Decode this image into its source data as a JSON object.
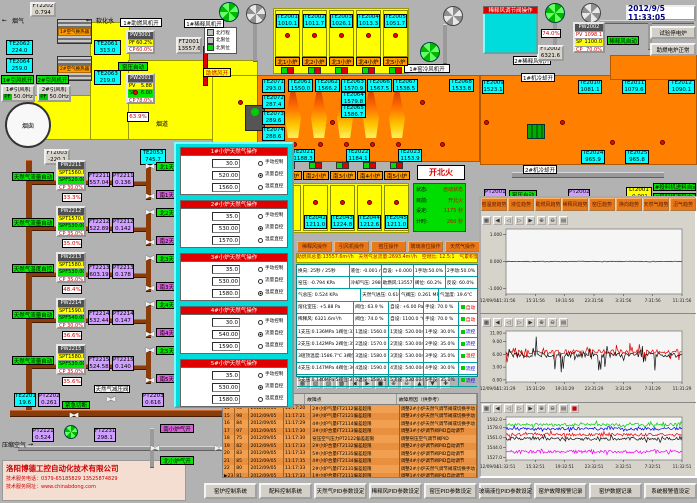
{
  "window": {
    "datetime": "2012/9/5 11:33:05"
  },
  "company": {
    "name": "洛阳博德工控自动化技术有限公司",
    "phone": "技术服务电话：0379-65185829  13525874829",
    "web": "技术服务网址：www.chinabdong.com"
  },
  "icons": {
    "valve": "▶◀",
    "left_arrow": "←",
    "right_arrow": "→",
    "row_pointer": "▶"
  },
  "labels": {
    "smoke": "烟气",
    "soft_water": "软化水",
    "hx1": "1#空气换热器",
    "hx2": "2#空气换热器",
    "fan1_on": "1#引风机开",
    "fan2_on": "2#引风机开",
    "fan1": "1#引风机",
    "fan2": "2#引风机",
    "pf": "PF",
    "fan1_hz": "50.0Hz",
    "fan2_hz": "50.0Hz",
    "chimney": "烟囱",
    "flue": "烟道",
    "damper_pct": "63.9%",
    "kiln_auto": "窑压自动",
    "kiln_auto2": "窑压自动",
    "blower1_on": "1#助燃风机开",
    "dilution1_on": "1#稀释风机开",
    "dilution2_on": "2#稀释风机开",
    "comb_air_on": "助燃风开",
    "mix_auto": "稀释风自动",
    "cool1": "1#机冷却开",
    "cool2": "2#机冷却开",
    "kiln_cool_fan": "1#窑冷风机开",
    "feed1": "1#投料机进料自动",
    "feed2": "2#投料机进料自动",
    "fire_mode": "开北火",
    "emergency": "紧急切断",
    "reducer_valve": "天然气减压阀",
    "comp_air": "压缩空气",
    "south_air_on": "南小炉气开",
    "north_air_on": "北小炉气开",
    "test_btn": "试验停电炉",
    "aux_btn": "助燃电炉正常",
    "limit_legend": [
      "北行程",
      "北限位",
      "北到位"
    ]
  },
  "inst": {
    "ft2202": [
      "FT2202",
      "0.794"
    ],
    "te2062": [
      "TE2062",
      "224.0"
    ],
    "te2061": [
      "TE2061",
      "313.0"
    ],
    "te2064": [
      "TE2064",
      "259.0"
    ],
    "te2063": [
      "TE2063",
      "219.0"
    ],
    "ft2001": [
      "FT2001",
      "13557.6"
    ],
    "ft2003": [
      "FT2003",
      "-220.1"
    ],
    "te2053": [
      "TE2053",
      "745.7"
    ],
    "ft2002": [
      "FT2002",
      "6321.6"
    ],
    "te2201": [
      "TE2201",
      "19.6"
    ],
    "pt2202": [
      "PT2202",
      "0.261"
    ],
    "pt2203": [
      "PT2203",
      "0.616"
    ],
    "pt2121": [
      "PT2121",
      "0.524"
    ],
    "ft2231": [
      "FT2231",
      "298.1"
    ],
    "pt2001": [
      "PT2001",
      "5.88"
    ],
    "pt2002": [
      "PT2002",
      "6.96"
    ],
    "lt2001": [
      "LT2001",
      "-0.001"
    ],
    "te2009": [
      "TE2009",
      "1523.1"
    ],
    "te2010": [
      "TE2010",
      "1081.1"
    ],
    "te2011": [
      "TE2011",
      "1079.6"
    ],
    "te2012": [
      "TE2012",
      "1090.1"
    ],
    "te2024": [
      "TE2024",
      "965.9"
    ],
    "te2025": [
      "TE2025",
      "965.8"
    ],
    "te2021": [
      "TE2021",
      "1188.3"
    ],
    "te2022": [
      "TE2022",
      "1184.1"
    ],
    "te2023": [
      "TE2023",
      "1153.9"
    ]
  },
  "north_block": {
    "title": "蓄热室",
    "te": [
      [
        "TE2001",
        "1010.1"
      ],
      [
        "TE2002",
        "1011.7"
      ],
      [
        "TE2003",
        "1026.1"
      ],
      [
        "TE2004",
        "1013.3"
      ],
      [
        "TE2005",
        "1051.7"
      ]
    ],
    "ports": [
      "北1小炉",
      "北2小炉",
      "北3小炉",
      "北4小炉",
      "北5小炉"
    ]
  },
  "south_block": {
    "title": "蓄热室",
    "te": [
      [
        "TE2042",
        "1211.0"
      ],
      [
        "TE2043",
        "1224.8"
      ],
      [
        "TE2044",
        "1212.6"
      ],
      [
        "TE2045",
        "1211.0"
      ]
    ],
    "ports": [
      "南1小炉",
      "南2小炉",
      "南3小炉",
      "南4小炉",
      "南5小炉"
    ]
  },
  "furnace": {
    "left_te": [
      [
        "TE2071",
        "293.0"
      ],
      [
        "TE2072",
        "287.4"
      ],
      [
        "TE2073",
        "289.6"
      ],
      [
        "TE2074",
        "288.6"
      ],
      [
        "TE2075",
        "291.7"
      ]
    ],
    "flame_te": [
      [
        "TE2061",
        "1550.0"
      ],
      [
        "TE2062",
        "1566.2"
      ],
      [
        "TE2063",
        "1570.9"
      ],
      [
        "TE2064",
        "1579.8"
      ],
      [
        "TE2065",
        "1586.7"
      ],
      [
        "TE2066",
        "1567.5"
      ],
      [
        "TE2067",
        "1538.5"
      ],
      [
        "TE2068",
        "1533.8"
      ]
    ]
  },
  "controllers": {
    "pw2001": {
      "id": "PW2001",
      "rows": [
        [
          "PV",
          "5.88"
        ],
        [
          "SP",
          "6.00"
        ],
        [
          "CP",
          "78.0%"
        ]
      ]
    },
    "pw3001": {
      "id": "PW3001",
      "rows": [
        [
          "PF",
          "60.2%"
        ],
        [
          "CP",
          "60.0%"
        ]
      ]
    },
    "pw2002": {
      "id": "PW2002",
      "rows": [
        [
          "PV",
          "1098.1"
        ],
        [
          "SP",
          "1100.0"
        ],
        [
          "CP",
          "70.0%"
        ]
      ]
    }
  },
  "dilution_popup": {
    "title": "稀释风调节阀操作",
    "manual_btn": "PV2002手动",
    "auto_btn": "自动",
    "rows": [
      [
        "PV2002自设:",
        "1100.0",
        "℃"
      ],
      [
        "PV2002手设:",
        "70.0",
        "%"
      ]
    ],
    "valve_pct": "74.0%"
  },
  "status_panel": {
    "rows": [
      [
        "状态:",
        "自动状态"
      ],
      [
        "目前:",
        "开北火"
      ],
      [
        "设定:",
        "1175 秒"
      ],
      [
        "计时:",
        "260 秒"
      ]
    ]
  },
  "gas_branches": {
    "row_labels": [
      "SPT",
      "SPF",
      "CP"
    ],
    "items": [
      {
        "id": "PW2211",
        "spt": "1560.0",
        "spf": "520.00",
        "cp": "30.0%",
        "pct": "33.3%",
        "ft": [
          "FT2211",
          "557.04"
        ],
        "pt": [
          "PT2211",
          "0.136"
        ],
        "mode": "天然气流量自动",
        "north": "北1天然气开",
        "south": "南1天然气开"
      },
      {
        "id": "PW2212",
        "spt": "1570.0",
        "spf": "530.00",
        "cp": "35.0%",
        "pct": "35.0%",
        "ft": [
          "FT2212",
          "522.89"
        ],
        "pt": [
          "PT2212",
          "0.142"
        ],
        "mode": "天然气流量自动",
        "north": "北2天然气开",
        "south": "南2天然气开"
      },
      {
        "id": "PW2213",
        "spt": "1580.0",
        "spf": "530.00",
        "cp": "35.0%",
        "pct": "48.4%",
        "ft": [
          "FT2213",
          "603.19"
        ],
        "pt": [
          "PT2213",
          "0.178"
        ],
        "mode": "天然气温度自控",
        "north": "北3天然气开",
        "south": "南3天然气开"
      },
      {
        "id": "PW2214",
        "spt": "1590.0",
        "spf": "540.00",
        "cp": "30.0%",
        "pct": "36.6%",
        "ft": [
          "FT2214",
          "532.44"
        ],
        "pt": [
          "PT2214",
          "0.147"
        ],
        "mode": "天然气流量自动",
        "north": "北4天然气开",
        "south": "南4天然气开"
      },
      {
        "id": "PW2215",
        "spt": "1580.0",
        "spf": "530.00",
        "cp": "35.0%",
        "pct": "35.6%",
        "ft": [
          "FT2215",
          "524.58"
        ],
        "pt": [
          "PT2215",
          "0.140"
        ],
        "mode": "天然气流量自动",
        "north": "北5天然气开",
        "south": "南5天然气开"
      }
    ]
  },
  "gas_popup": {
    "field_labels": [
      "手动设定:",
      "流量设定:",
      "温度设定:"
    ],
    "units": [
      "%",
      "m³/h",
      "℃"
    ],
    "radios": [
      "手动控制",
      "流量自控",
      "温度直控"
    ],
    "panels": [
      {
        "title": "1#小炉天然气操作",
        "manual": "30.0",
        "flow": "520.00",
        "temp": "1560.0",
        "sel": 1
      },
      {
        "title": "2#小炉天然气操作",
        "manual": "35.0",
        "flow": "530.00",
        "temp": "1570.0",
        "sel": 1
      },
      {
        "title": "3#小炉天然气操作",
        "manual": "35.0",
        "flow": "530.00",
        "temp": "1580.0",
        "sel": 2
      },
      {
        "title": "4#小炉天然气操作",
        "manual": "30.0",
        "flow": "540.00",
        "temp": "1590.0",
        "sel": 1
      },
      {
        "title": "5#小炉天然气操作",
        "manual": "35.0",
        "flow": "530.00",
        "temp": "1580.0",
        "sel": 1
      }
    ]
  },
  "op_buttons": [
    "稀释风操作",
    "引风机操作",
    "窑压操作",
    "玻璃液位操作",
    "天然气操作"
  ],
  "totals_bar": "助燃风总量:13557.6m³/h　天然气总流量:2693.4m³/h　空燃比: 12.5:1　气累积量: 134057.7m³",
  "data_grid": [
    {
      "cells": [
        "换向: 25秒 / 25秒",
        "液位: -0.001 mm",
        "自设: +0.000 mm",
        "1手动:50.0% 自动",
        "2手动:50.0% 自动"
      ],
      "chip": ""
    },
    {
      "cells": [
        "窑压: -0.794 KPa",
        "冷却气压: 298.1 KPa",
        "助燃风:13557.6m³/h",
        "阀位: 60.2%",
        "反设: 60.0%"
      ],
      "chip": ""
    },
    {
      "cells": [
        "气总压: 0.524 KPa",
        "天然气进压: 0.616 MPa",
        "气阀压: 0.261 MPa",
        "气温度: 19.6℃"
      ],
      "chip": ""
    },
    {
      "cells": [
        "熔化室压: +5.88 Pa",
        "阀位: 63.9 %",
        "自设: +6.00 Pa",
        "手设: 70.0 %"
      ],
      "chip": "自动"
    },
    {
      "cells": [
        "稀释风: 6321.6m³/h",
        "阀位: 74.0 %",
        "自设: 1100.0 ℃",
        "手设: 70.0 %"
      ],
      "chip": "自动"
    },
    {
      "cells": [
        "1支压:0.136MPa 1阀位:33.3%",
        "1温设: 1560.0 ℃",
        "1流设: 520.00m³/h",
        "1手设: 30.0%"
      ],
      "chip": "流控"
    },
    {
      "cells": [
        "2支压:0.142MPa 2阀位:35.0%",
        "2温设: 1570.0 ℃",
        "2流设: 530.00m³/h",
        "2手设: 35.0%"
      ],
      "chip": "流控"
    },
    {
      "cells": [
        "3碹顶温度:1586.7℃ 3阀位:48.4%",
        "3温设: 1580.0 ℃",
        "3流设: 530.00m³/h",
        "3手设: 35.0%"
      ],
      "chip": "温控"
    },
    {
      "cells": [
        "4支压:0.147MPa 4阀位:36.6%",
        "4温设: 1590.0 ℃",
        "4流设: 540.00m³/h",
        "4手设: 30.0%"
      ],
      "chip": "流控"
    },
    {
      "cells": [
        "5支压:0.140MPa 5阀位:35.6%",
        "5温设: 1580.0 ℃",
        "5流设: 530.00m³/h",
        "5手设: 35.0%"
      ],
      "chip": "流控"
    }
  ],
  "toolbar_icons": [
    "▦",
    "▧",
    "▨",
    "▩",
    "◀",
    "▶",
    "■",
    "⊕",
    "⊖",
    "▲",
    "▼",
    "✚"
  ],
  "chart_toolbar_icons": [
    "▦",
    "◀",
    "◁",
    "▷",
    "▶",
    "⊕",
    "⊖",
    "▤"
  ],
  "alarm_table": {
    "headers": [
      "",
      "故障点",
      "故障原因（供参考）"
    ],
    "rows": [
      [
        "14",
        "96",
        "2012/09/05",
        "11:17:20",
        "2#小炉气量FT2112偏差超限",
        "调整2#小炉天然气调节阀或切换手动"
      ],
      [
        "15",
        "98",
        "2012/09/05",
        "11:17:21",
        "3#小炉气量FT2121偏差超限",
        "调整3#小炉天然气调节阀或切换手动"
      ],
      [
        "16",
        "84",
        "2012/09/05",
        "11:17:29",
        "4#小炉气量FT2114偏差超限",
        "调整4#小炉天然气调节阀或切换手动"
      ],
      [
        "17",
        "97",
        "2012/09/05",
        "11:17:30",
        "3#小炉合量FT2113偏差超限",
        "调整3#小炉调节阀PID自动调节"
      ],
      [
        "18",
        "75",
        "2012/09/05",
        "11:17:30",
        "窑压空气压力PT2122偏差超限",
        "调整窑压空气调节阀PID"
      ],
      [
        "19",
        "82",
        "2012/09/05",
        "11:17:33",
        "2#小炉合量FT2132偏差超限",
        "调整2#小炉调节阀PID自动调节"
      ],
      [
        "20",
        "83",
        "2012/09/05",
        "11:17:33",
        "5#小炉合量FT2135偏差超限",
        "调整5#小炉调节阀PID自动调节"
      ],
      [
        "21",
        "85",
        "2012/09/05",
        "11:17:35",
        "4#小炉合量FT2134偏差超限",
        "调整4#小炉调节阀PID自动调节"
      ],
      [
        "22",
        "80",
        "2012/09/05",
        "11:17:33",
        "2#小炉气量FT2131偏差超限",
        "调整2#小炉天然气调节阀或切换手动"
      ],
      [
        "23",
        "81",
        "2012/09/05",
        "11:17:33",
        "1#小炉合量FT2111偏差超限",
        "调整1#小炉调节阀PID自动调节"
      ]
    ]
  },
  "trend_buttons": [
    "窑温度趋势",
    "液位趋势",
    "助燃风趋势",
    "稀释风趋势",
    "窑压趋势",
    "换向趋势",
    "天然气趋势",
    "沼气趋势"
  ],
  "chart_data": [
    {
      "type": "line",
      "name": "玻璃液位趋势",
      "ylim": [
        -1.2,
        1.2
      ],
      "yticks": [
        "1.000",
        "0.000",
        "-1.000"
      ],
      "ytick_vals": [
        1,
        0,
        -1
      ],
      "date": "12/09/04",
      "xticks": [
        "11:31:56",
        "15:31:56",
        "19:31:56",
        "23:31:56",
        "3:31:56",
        "7:31:56",
        "11:31:56"
      ],
      "series": [
        {
          "name": "玻璃液位",
          "color": "#222222",
          "base": 0.0,
          "noise": 0.015,
          "spike": 0
        }
      ]
    },
    {
      "type": "line",
      "name": "窑压趋势",
      "ylim": [
        -0.5,
        11.5
      ],
      "yticks": [
        "11.00",
        "9.00",
        "6.00",
        "3.00",
        "0.00"
      ],
      "ytick_vals": [
        11,
        9,
        6,
        3,
        0
      ],
      "date": "12/09/04",
      "xticks": [
        "11:31:29",
        "15:31:29",
        "19:31:29",
        "23:31:29",
        "3:31:29",
        "7:31:29",
        "11:31:29"
      ],
      "series": [
        {
          "name": "窑压PV",
          "color": "#dd0000",
          "base": 6.6,
          "noise": 0.5,
          "spike": 2.2
        },
        {
          "name": "窑压",
          "color": "#111111",
          "base": 5.9,
          "noise": 0.6,
          "spike": 4.5
        }
      ]
    },
    {
      "type": "line",
      "name": "窑温趋势",
      "ylim": [
        1523,
        1596
      ],
      "yticks": [
        "1592.0",
        "1578.0",
        "1561.0",
        "1544.0",
        "1527.0"
      ],
      "ytick_vals": [
        1592,
        1578,
        1561,
        1544,
        1527
      ],
      "date": "12/09/04",
      "xticks": [
        "11:32:51",
        "15:32:51",
        "19:32:51",
        "23:32:51",
        "3:32:51",
        "7:32:51",
        "11:32:51"
      ],
      "series": [
        {
          "name": "1#炉温",
          "color": "#00cc00",
          "base": 1583,
          "noise": 2.5,
          "spike": 5
        },
        {
          "name": "2#炉温",
          "color": "#0000ee",
          "base": 1576,
          "noise": 2.5,
          "spike": 5
        },
        {
          "name": "3#炉温",
          "color": "#ee0000",
          "base": 1566,
          "noise": 2.5,
          "spike": 5
        },
        {
          "name": "4#炉温",
          "color": "#111111",
          "base": 1559,
          "noise": 2.5,
          "spike": 5
        },
        {
          "name": "5#炉温",
          "color": "#ee00ee",
          "base": 1537,
          "noise": 2.5,
          "spike": 5
        }
      ]
    }
  ],
  "bottom_buttons": [
    "窑炉控制系统",
    "配料控制系统",
    "天然气PID参数设定",
    "稀释风PID参数设定",
    "窑压PID参数设定",
    "玻璃液位PID参数设定",
    "窑炉故障报警记录",
    "窑炉数据记录",
    "系统报警值设定"
  ]
}
